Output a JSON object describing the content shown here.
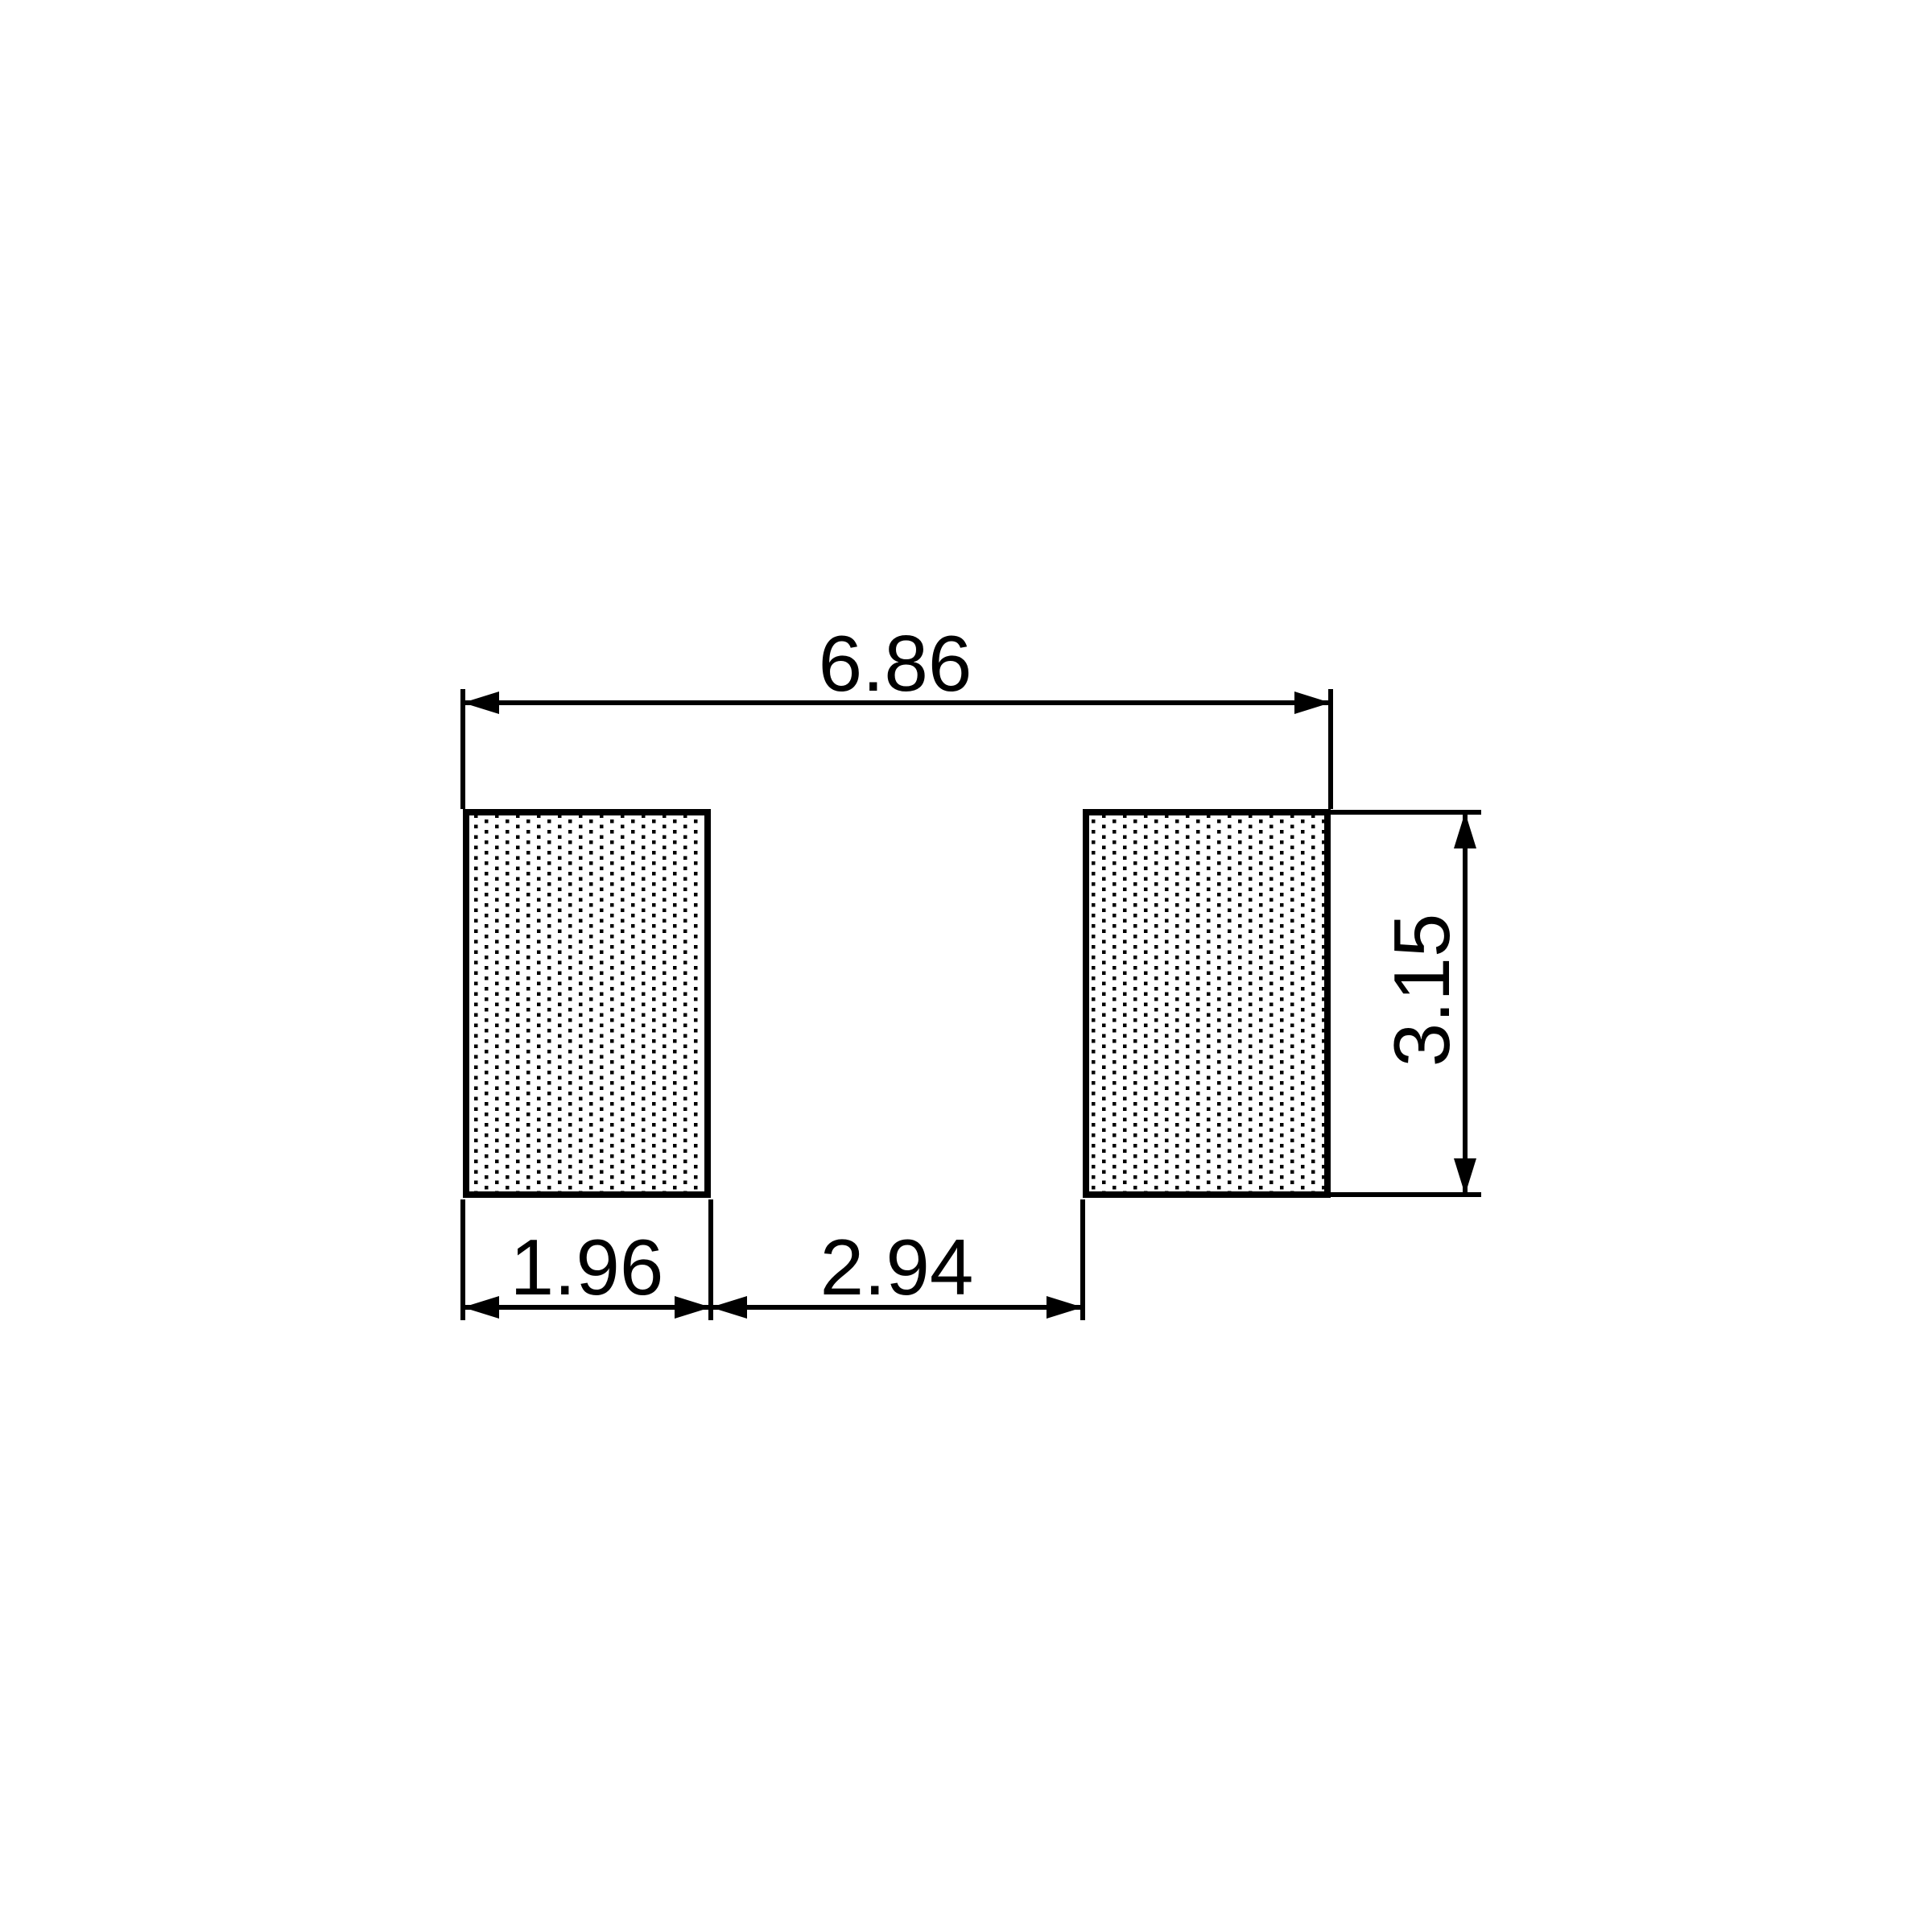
{
  "page": {
    "background_color": "#ffffff",
    "ink_color": "#000000"
  },
  "drawing": {
    "kind": "pad-land-pattern-dimension-drawing",
    "dimensions": {
      "overall_width": "6.86",
      "pad_width": "1.96",
      "pad_gap": "2.94",
      "pad_height": "3.15"
    }
  }
}
